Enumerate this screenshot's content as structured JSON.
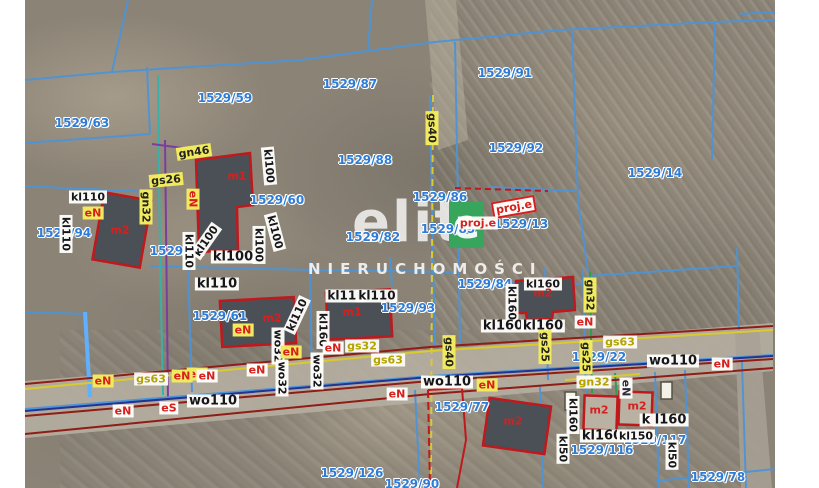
{
  "map": {
    "watermark": {
      "brand": "elit",
      "brand_e": "e",
      "green_color": "#37a55b",
      "subtitle": "NIERUCHOMOŚCI"
    },
    "colors": {
      "parcel_line": "#4e94d6",
      "parcel_text": "#2e7cd6",
      "building_outline": "#c0181c",
      "road_red": "#8f1d15",
      "road_navy": "#24338f",
      "gas_yellow": "#d9ca2e",
      "green_utility": "#2e9e4f",
      "label_yellow_bg": "#f1ea5e"
    },
    "parcel_labels": [
      {
        "text": "1529/63",
        "x": 82,
        "y": 123
      },
      {
        "text": "1529/59",
        "x": 225,
        "y": 98
      },
      {
        "text": "1529/87",
        "x": 350,
        "y": 84
      },
      {
        "text": "1529/91",
        "x": 505,
        "y": 73
      },
      {
        "text": "1529/92",
        "x": 516,
        "y": 148
      },
      {
        "text": "1529/88",
        "x": 365,
        "y": 160
      },
      {
        "text": "1529/14",
        "x": 655,
        "y": 173
      },
      {
        "text": "1529/60",
        "x": 277,
        "y": 200
      },
      {
        "text": "1529/86",
        "x": 440,
        "y": 197
      },
      {
        "text": "1529/85",
        "x": 448,
        "y": 229
      },
      {
        "text": "1529/13",
        "x": 521,
        "y": 224
      },
      {
        "text": "1529/94",
        "x": 64,
        "y": 233
      },
      {
        "text": "1529/62",
        "x": 177,
        "y": 251
      },
      {
        "text": "1529/82",
        "x": 373,
        "y": 237
      },
      {
        "text": "1529/61",
        "x": 220,
        "y": 316
      },
      {
        "text": "1529/93",
        "x": 408,
        "y": 308
      },
      {
        "text": "1529/84",
        "x": 485,
        "y": 284
      },
      {
        "text": "1529/22",
        "x": 599,
        "y": 357
      },
      {
        "text": "1529/77",
        "x": 462,
        "y": 407
      },
      {
        "text": "1529/126",
        "x": 352,
        "y": 473
      },
      {
        "text": "1529/90",
        "x": 412,
        "y": 484
      },
      {
        "text": "1529/116",
        "x": 602,
        "y": 450
      },
      {
        "text": "1529/117",
        "x": 655,
        "y": 440
      },
      {
        "text": "1529/78",
        "x": 718,
        "y": 477
      }
    ],
    "utility_labels": [
      {
        "text": "gn46",
        "x": 194,
        "y": 152,
        "rot": -8,
        "style": "yellow"
      },
      {
        "text": "gs26",
        "x": 166,
        "y": 180,
        "rot": -5,
        "style": "yellow"
      },
      {
        "text": "gn32",
        "x": 146,
        "y": 207,
        "rot": 90,
        "style": "yellow"
      },
      {
        "text": "kl110",
        "x": 88,
        "y": 197,
        "rot": 0,
        "style": "white"
      },
      {
        "text": "eN",
        "x": 93,
        "y": 213,
        "rot": 0,
        "style": "red-yellow"
      },
      {
        "text": "kl110",
        "x": 66,
        "y": 234,
        "rot": 90,
        "style": "white"
      },
      {
        "text": "eN",
        "x": 193,
        "y": 199,
        "rot": 90,
        "style": "red-yellow"
      },
      {
        "text": "kl100",
        "x": 269,
        "y": 166,
        "rot": 85,
        "style": "white"
      },
      {
        "text": "kl100",
        "x": 206,
        "y": 241,
        "rot": -55,
        "style": "white"
      },
      {
        "text": "kl100",
        "x": 233,
        "y": 257,
        "rot": 0,
        "style": "white",
        "fs": 13
      },
      {
        "text": "kl100",
        "x": 259,
        "y": 245,
        "rot": 90,
        "style": "white"
      },
      {
        "text": "kl100",
        "x": 275,
        "y": 232,
        "rot": 75,
        "style": "white"
      },
      {
        "text": "kl110",
        "x": 189,
        "y": 251,
        "rot": 90,
        "style": "white"
      },
      {
        "text": "kl110",
        "x": 217,
        "y": 284,
        "rot": 0,
        "style": "white",
        "fs": 13
      },
      {
        "text": "kl110",
        "x": 297,
        "y": 315,
        "rot": -65,
        "style": "white"
      },
      {
        "text": "kl160",
        "x": 323,
        "y": 330,
        "rot": 90,
        "style": "white"
      },
      {
        "text": "kl110",
        "x": 346,
        "y": 296,
        "rot": 0,
        "style": "white",
        "fs": 12
      },
      {
        "text": "kl110",
        "x": 377,
        "y": 296,
        "rot": 0,
        "style": "white",
        "fs": 12
      },
      {
        "text": "eN",
        "x": 243,
        "y": 330,
        "rot": 0,
        "style": "red-yellow"
      },
      {
        "text": "eN",
        "x": 333,
        "y": 348,
        "rot": 0,
        "style": "red-white"
      },
      {
        "text": "gs32",
        "x": 362,
        "y": 346,
        "rot": 0,
        "style": "olive"
      },
      {
        "text": "gs63",
        "x": 388,
        "y": 360,
        "rot": 0,
        "style": "olive"
      },
      {
        "text": "wo32",
        "x": 278,
        "y": 346,
        "rot": 90,
        "style": "white"
      },
      {
        "text": "wo32",
        "x": 282,
        "y": 378,
        "rot": 90,
        "style": "white"
      },
      {
        "text": "wo32",
        "x": 317,
        "y": 371,
        "rot": 90,
        "style": "white"
      },
      {
        "text": "eN",
        "x": 257,
        "y": 370,
        "rot": 0,
        "style": "red-white"
      },
      {
        "text": "eN",
        "x": 291,
        "y": 352,
        "rot": 0,
        "style": "red-yellow"
      },
      {
        "text": "eN",
        "x": 197,
        "y": 374,
        "rot": 0,
        "style": "red-yellow"
      },
      {
        "text": "kl160",
        "x": 543,
        "y": 284,
        "rot": 0,
        "style": "white"
      },
      {
        "text": "kl160",
        "x": 512,
        "y": 303,
        "rot": 90,
        "style": "white"
      },
      {
        "text": "kl160",
        "x": 503,
        "y": 326,
        "rot": 0,
        "style": "white",
        "fs": 13
      },
      {
        "text": "kl160",
        "x": 543,
        "y": 326,
        "rot": 0,
        "style": "white",
        "fs": 13
      },
      {
        "text": "eN",
        "x": 585,
        "y": 322,
        "rot": 0,
        "style": "red-white"
      },
      {
        "text": "gn32",
        "x": 590,
        "y": 295,
        "rot": 90,
        "style": "yellow"
      },
      {
        "text": "gs25",
        "x": 545,
        "y": 347,
        "rot": 90,
        "style": "yellow"
      },
      {
        "text": "gs25",
        "x": 586,
        "y": 357,
        "rot": 90,
        "style": "yellow"
      },
      {
        "text": "gs63",
        "x": 620,
        "y": 342,
        "rot": 0,
        "style": "olive"
      },
      {
        "text": "gs63",
        "x": 151,
        "y": 379,
        "rot": 0,
        "style": "olive"
      },
      {
        "text": "eN",
        "x": 103,
        "y": 381,
        "rot": 0,
        "style": "red-yellow"
      },
      {
        "text": "eN",
        "x": 182,
        "y": 376,
        "rot": 0,
        "style": "red-yellow"
      },
      {
        "text": "eN",
        "x": 207,
        "y": 376,
        "rot": 0,
        "style": "red-white"
      },
      {
        "text": "eN",
        "x": 123,
        "y": 411,
        "rot": 0,
        "style": "red-white"
      },
      {
        "text": "eS",
        "x": 169,
        "y": 408,
        "rot": 0,
        "style": "red-white"
      },
      {
        "text": "wo110",
        "x": 213,
        "y": 401,
        "rot": 0,
        "style": "white",
        "fs": 13
      },
      {
        "text": "wo110",
        "x": 447,
        "y": 382,
        "rot": 0,
        "style": "white",
        "fs": 13
      },
      {
        "text": "eN",
        "x": 487,
        "y": 385,
        "rot": 0,
        "style": "red-yellow"
      },
      {
        "text": "eN",
        "x": 397,
        "y": 394,
        "rot": 0,
        "style": "red-white"
      },
      {
        "text": "wo110",
        "x": 673,
        "y": 361,
        "rot": 0,
        "style": "white",
        "fs": 13
      },
      {
        "text": "eN",
        "x": 722,
        "y": 364,
        "rot": 0,
        "style": "red-white"
      },
      {
        "text": "gn32",
        "x": 594,
        "y": 382,
        "rot": 0,
        "style": "olive"
      },
      {
        "text": "eN",
        "x": 626,
        "y": 388,
        "rot": 90,
        "style": "dark-white"
      },
      {
        "text": "gs40",
        "x": 432,
        "y": 128,
        "rot": 90,
        "style": "yellow"
      },
      {
        "text": "gs40",
        "x": 449,
        "y": 352,
        "rot": 90,
        "style": "yellow"
      },
      {
        "text": "proj.e",
        "x": 514,
        "y": 207,
        "rot": -10,
        "style": "red-box"
      },
      {
        "text": "proj.e",
        "x": 478,
        "y": 223,
        "rot": 0,
        "style": "red-white"
      },
      {
        "text": "kl160",
        "x": 573,
        "y": 415,
        "rot": 90,
        "style": "white"
      },
      {
        "text": "kl160",
        "x": 602,
        "y": 436,
        "rot": 0,
        "style": "white",
        "fs": 13
      },
      {
        "text": "kl150",
        "x": 636,
        "y": 436,
        "rot": 0,
        "style": "white"
      },
      {
        "text": "k l160",
        "x": 664,
        "y": 420,
        "rot": 0,
        "style": "white",
        "fs": 13
      },
      {
        "text": "kl50",
        "x": 672,
        "y": 455,
        "rot": 90,
        "style": "white"
      },
      {
        "text": "kl50",
        "x": 563,
        "y": 449,
        "rot": 90,
        "style": "white"
      }
    ],
    "building_labels": [
      {
        "text": "m1",
        "x": 237,
        "y": 176
      },
      {
        "text": "m2",
        "x": 120,
        "y": 230
      },
      {
        "text": "m2",
        "x": 272,
        "y": 318
      },
      {
        "text": "m1",
        "x": 352,
        "y": 312
      },
      {
        "text": "m2",
        "x": 543,
        "y": 293
      },
      {
        "text": "m2",
        "x": 513,
        "y": 421
      },
      {
        "text": "m2",
        "x": 599,
        "y": 410
      },
      {
        "text": "m2",
        "x": 637,
        "y": 406
      }
    ]
  }
}
